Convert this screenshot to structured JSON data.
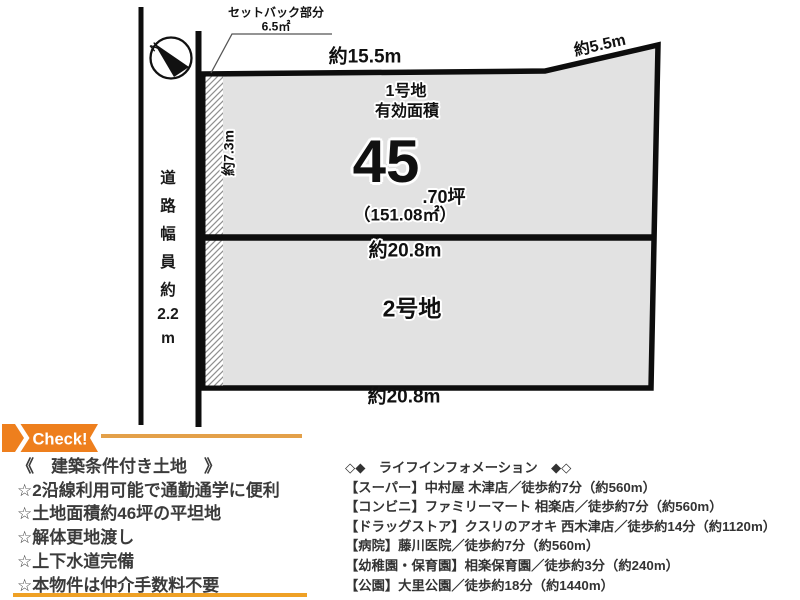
{
  "diagram": {
    "setback_label": "セットバック部分",
    "setback_area": "6.5㎡",
    "compass_north": "N",
    "road_label_chars": [
      "道",
      "路",
      "幅",
      "員",
      "約",
      "2.2",
      "m"
    ],
    "dim_top": "約15.5m",
    "dim_top_right": "約5.5m",
    "dim_left": "約7.3m",
    "dim_middle": "約20.8m",
    "dim_bottom": "約20.8m",
    "plot1": {
      "name": "1号地",
      "area_label": "有効面積",
      "tsubo_main": "45",
      "tsubo_frac": ".70坪",
      "sqm": "（151.08㎡）"
    },
    "plot2": {
      "name": "2号地"
    }
  },
  "check": {
    "ribbon": "Check!",
    "items": [
      "《　建築条件付き土地　》",
      "☆2沿線利用可能で通勤通学に便利",
      "☆土地面積約46坪の平坦地",
      "☆解体更地渡し",
      "☆上下水道完備",
      "☆本物件は仲介手数料不要"
    ]
  },
  "life_info": {
    "title": "◇◆　ライフインフォメーション　◆◇",
    "items": [
      "【スーパー】中村屋 木津店／徒歩約7分（約560m）",
      "【コンビニ】ファミリーマート 相楽店／徒歩約7分（約560m）",
      "【ドラッグストア】クスリのアオキ 西木津店／徒歩約14分（約1120m）",
      "【病院】藤川医院／徒歩約7分（約560m）",
      "【幼稚園・保育園】相楽保育園／徒歩約3分（約240m）",
      "【公園】大里公園／徒歩約18分（約1440m）"
    ]
  },
  "colors": {
    "accent_orange": "#ee7f1d",
    "rule_orange_top": "#e3a049",
    "rule_orange_bottom": "#efa125",
    "plot_fill": "#e2e2e2",
    "outline_black": "#0d0d0d"
  }
}
